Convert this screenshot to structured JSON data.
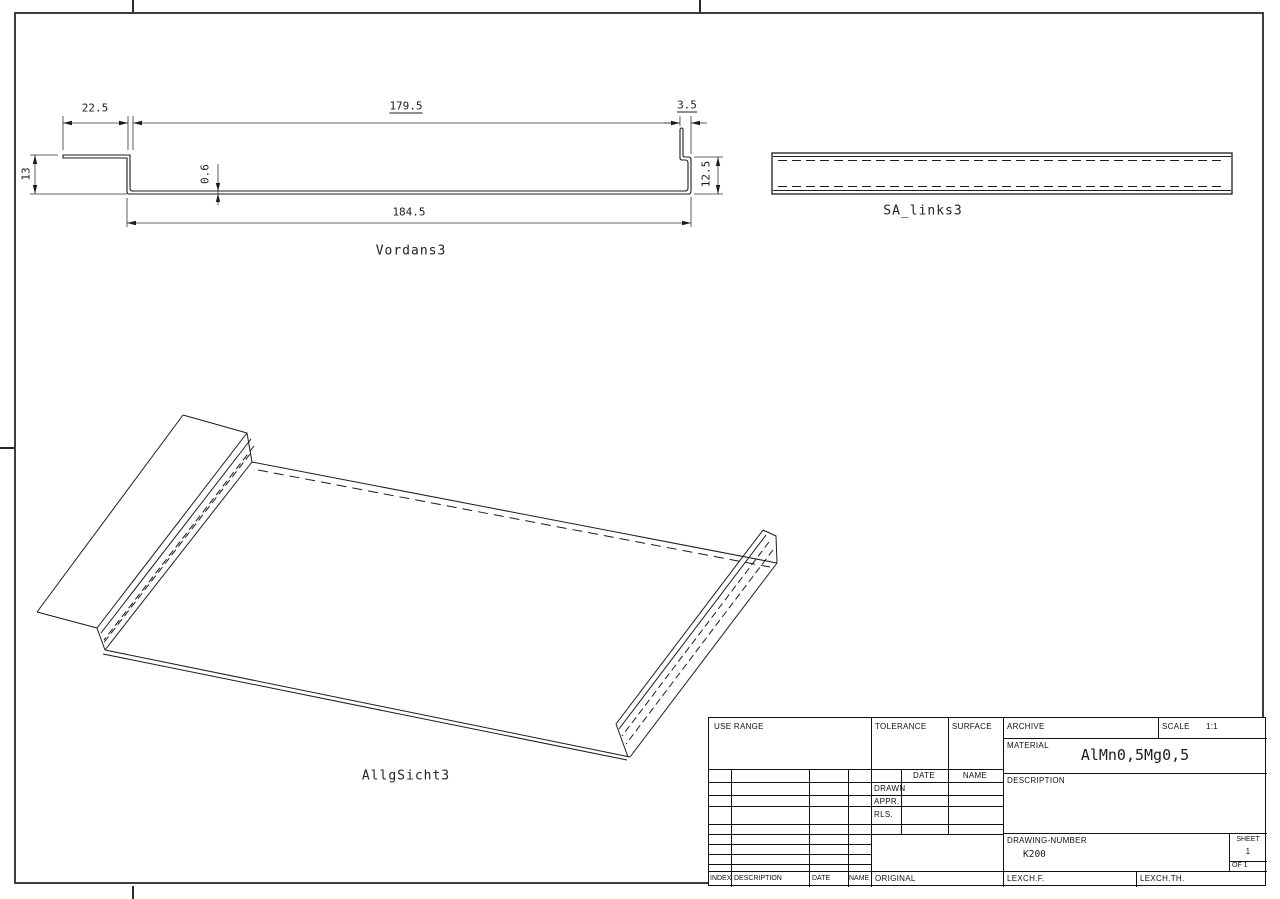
{
  "sheet": {
    "views": {
      "front": {
        "label": "Vordans3",
        "dims": {
          "flange_width": "22.5",
          "top_length": "179.5",
          "lip_offset": "3.5",
          "wall_height": "13",
          "thickness": "0.6",
          "total_length": "184.5",
          "lip_height": "12.5"
        }
      },
      "side": {
        "label": "SA_links3"
      },
      "iso": {
        "label": "AllgSicht3"
      }
    },
    "title_block": {
      "use_range_label": "USE RANGE",
      "tolerance_label": "TOLERANCE",
      "surface_label": "SURFACE",
      "archive_label": "ARCHIVE",
      "scale_label": "SCALE",
      "scale_value": "1:1",
      "material_label": "MATERIAL",
      "material_value": "AlMn0,5Mg0,5",
      "description_label": "DESCRIPTION",
      "date_label": "DATE",
      "name_label": "NAME",
      "drawn_label": "DRAWN",
      "appr_label": "APPR.",
      "rls_label": "RLS.",
      "drawing_number_label": "DRAWING-NUMBER",
      "drawing_number_value": "K200",
      "sheet_label": "SHEET",
      "sheet_value": "1",
      "of_label": "OF 1",
      "index_label": "INDEX",
      "description2_label": "DESCRIPTION",
      "date2_label": "DATE",
      "name2_label": "NAME",
      "original_label": "ORIGINAL",
      "lexchf_label": "LEXCH.F.",
      "lexchth_label": "LEXCH.TH."
    },
    "colors": {
      "line": "#1c1c1c",
      "frame": "#3d3d3d",
      "bg": "#ffffff"
    }
  }
}
